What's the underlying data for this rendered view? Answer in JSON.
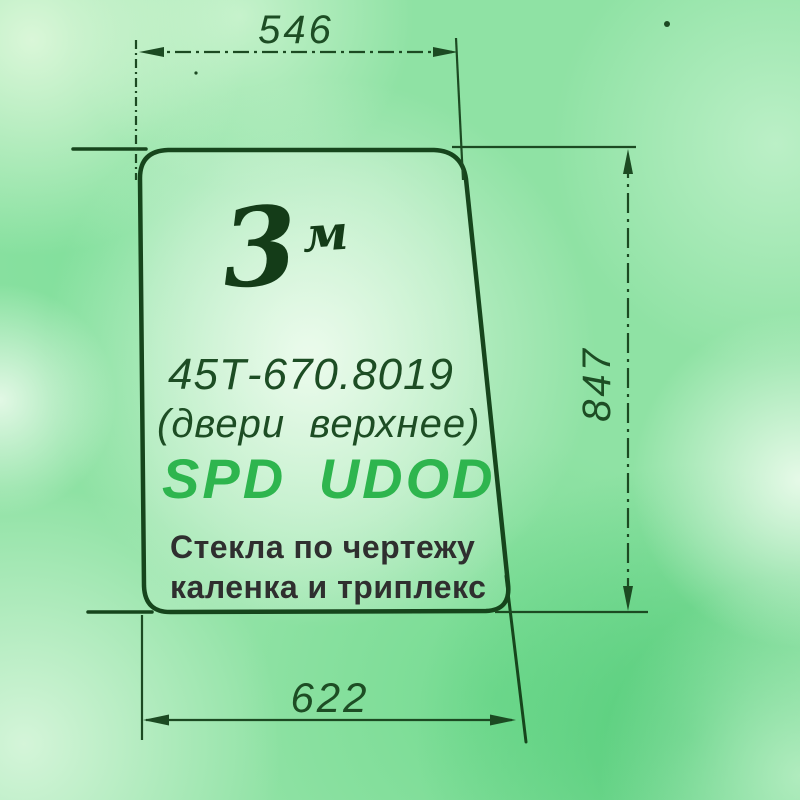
{
  "drawing": {
    "title_context": "technical sketch of a door glass panel",
    "sketch_quantity": "3",
    "sketch_unit": "м",
    "part_number": "45Т-670.8019",
    "part_description": "(двери  верхнее)",
    "brand": "SPD UDOD",
    "note_line1": "Стекла по чертежу",
    "note_line2": "каленка и триплекс",
    "dimensions": {
      "top_width": "546",
      "right_height": "847",
      "bottom_width": "622"
    },
    "colors": {
      "outline_dark_green": "#16451c",
      "ink_green": "#1d4d24",
      "handwriting_ink": "#143c18",
      "brand_green": "#2eb54e",
      "note_gray": "#2f2f2f",
      "background_green": "#8fe2a4"
    }
  }
}
